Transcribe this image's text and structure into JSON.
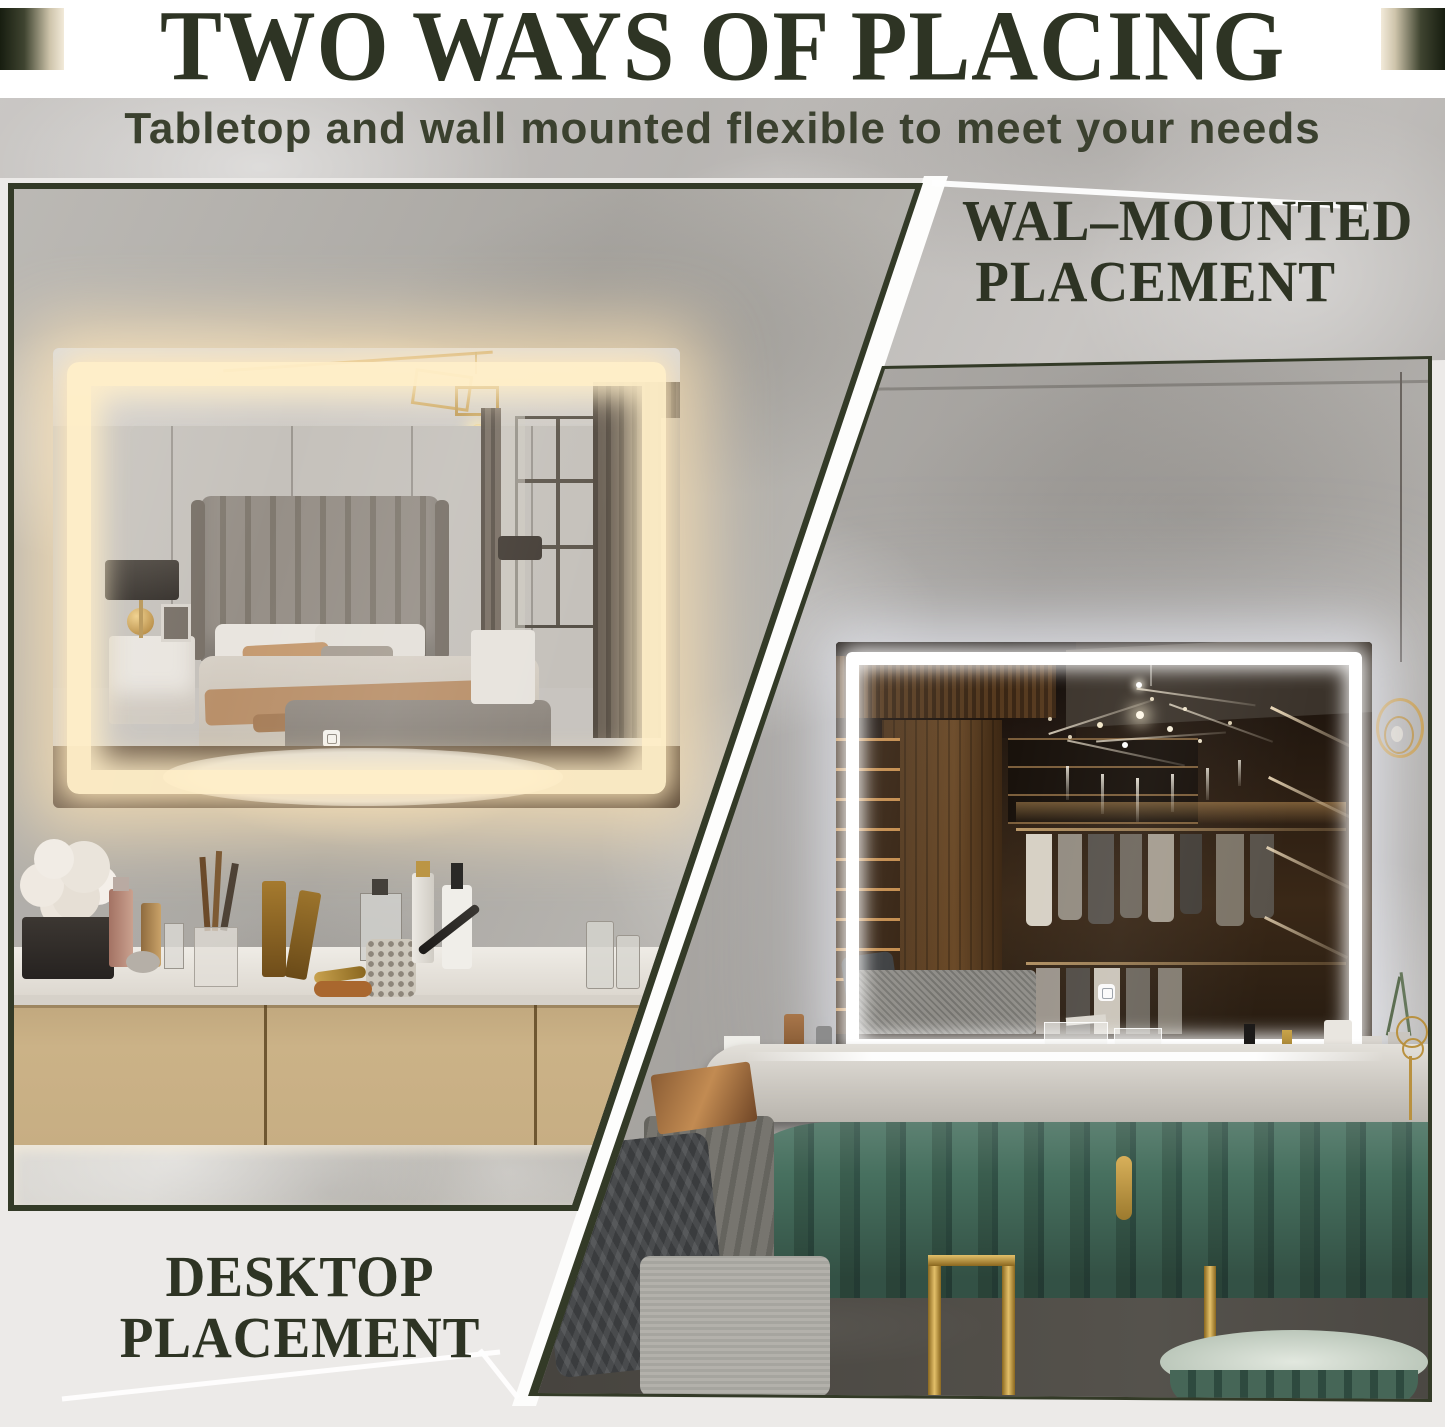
{
  "header": {
    "title": "TWO WAYS OF PLACING",
    "subtitle": "Tabletop and wall mounted flexible to meet your needs"
  },
  "panels": {
    "wall_mounted": {
      "line1": "WAL–MOUNTED",
      "line2": "PLACEMENT"
    },
    "desktop": {
      "line1": "DESKTOP",
      "line2": "PLACEMENT"
    }
  },
  "colors": {
    "accent_text": "#2e3424",
    "photo_border": "#333a27",
    "warm_led": "#ffeec8",
    "cool_led": "#ffffff",
    "background": "#ffffff",
    "panel_background": "#eceae8"
  }
}
